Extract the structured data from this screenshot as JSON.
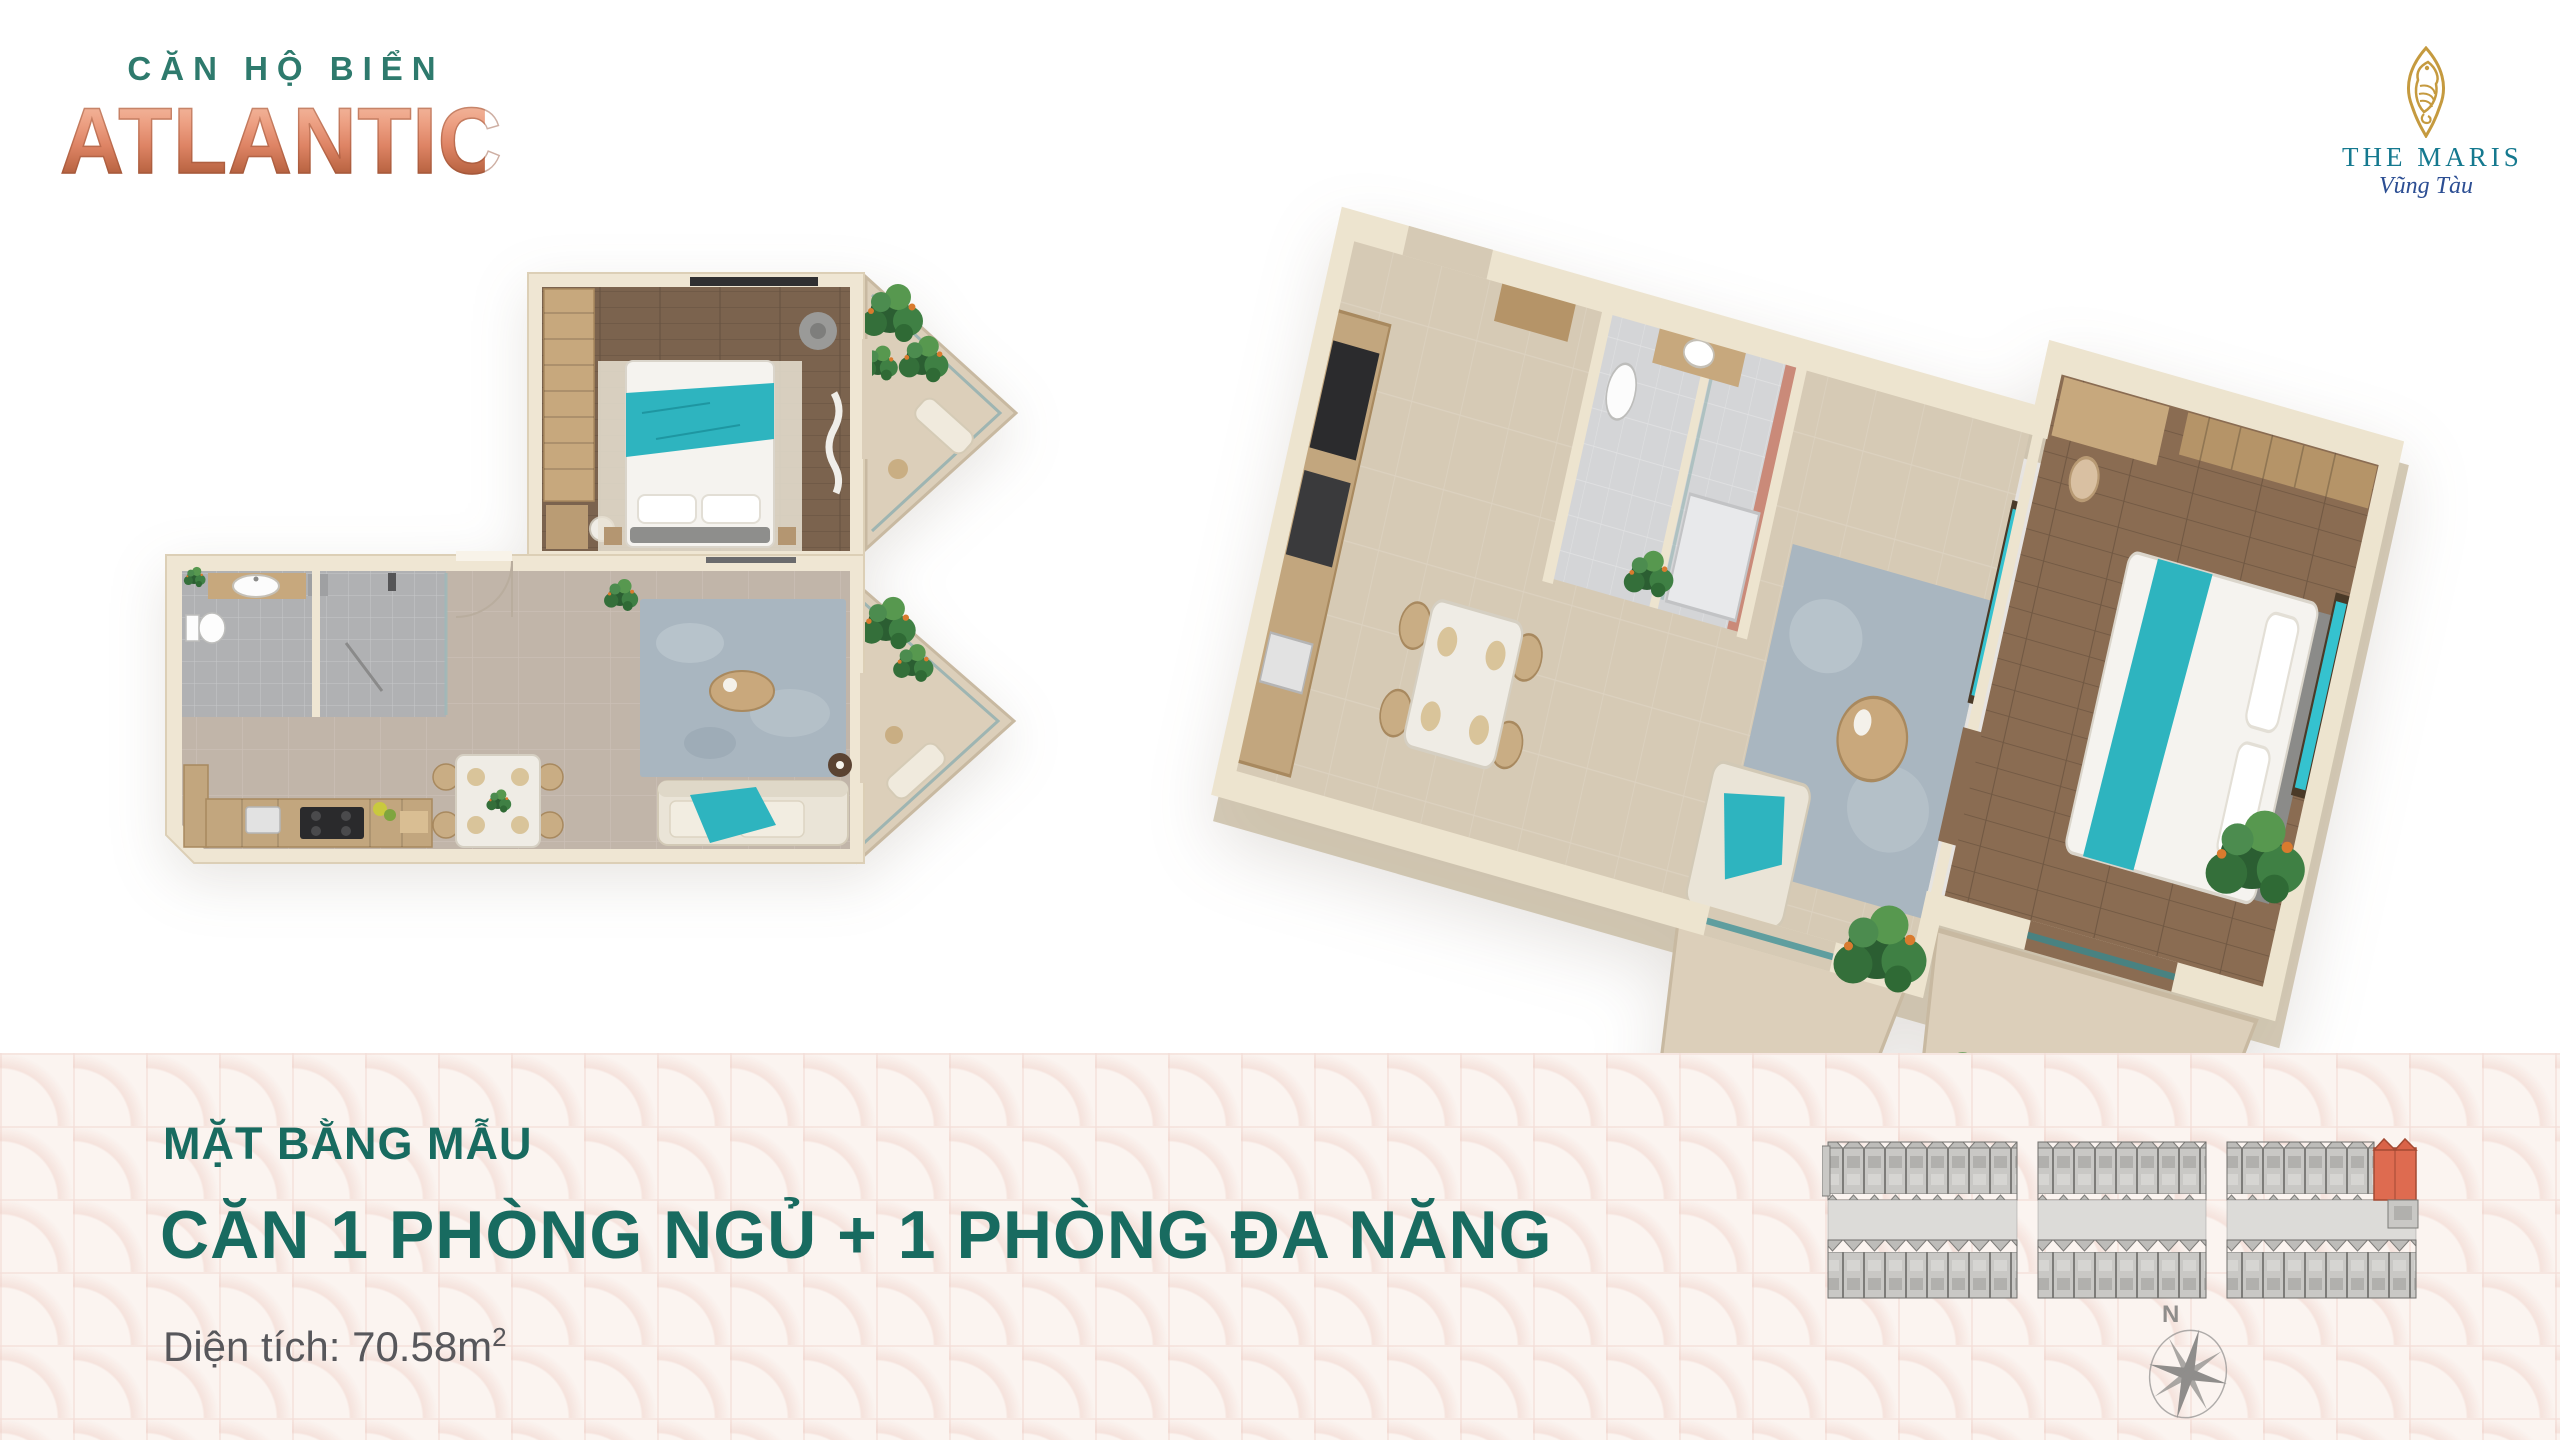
{
  "brand": {
    "tagline": "CĂN HỘ BIỂN",
    "name": "ATLANTIC"
  },
  "developer": {
    "name": "THE MARIS",
    "location": "Vũng Tàu"
  },
  "plan_info": {
    "heading": "MẶT BẰNG MẪU",
    "unit_type": "CĂN 1 PHÒNG NGỦ + 1 PHÒNG ĐA NĂNG",
    "area_label": "Diện tích: 70.58m",
    "area_superscript": "2"
  },
  "compass": {
    "north_label": "N"
  },
  "icons": {
    "developer_logo": "seahorse-marquise-badge",
    "compass": "compass-rose",
    "key_plan": "building-floor-key-plan"
  },
  "colors": {
    "heading_teal": "#186B60",
    "brand_teal": "#2E7A6D",
    "brand_copper": "#DE8465",
    "developer_gold": "#C Guard",
    "developer_gold_hex": "#C59A3F",
    "developer_teal": "#15798F",
    "developer_blue": "#2C4E93",
    "body_gray": "#57575B",
    "band_background": "#FBF4F0",
    "wall_cream": "#EFE6D3",
    "floor_taupe": "#C1B5A9",
    "wood_dark": "#7B634E",
    "accent_teal": "#2EB4BF",
    "highlighted_unit_red": "#DE6B50",
    "keyplan_gray": "#C9C8C5"
  }
}
